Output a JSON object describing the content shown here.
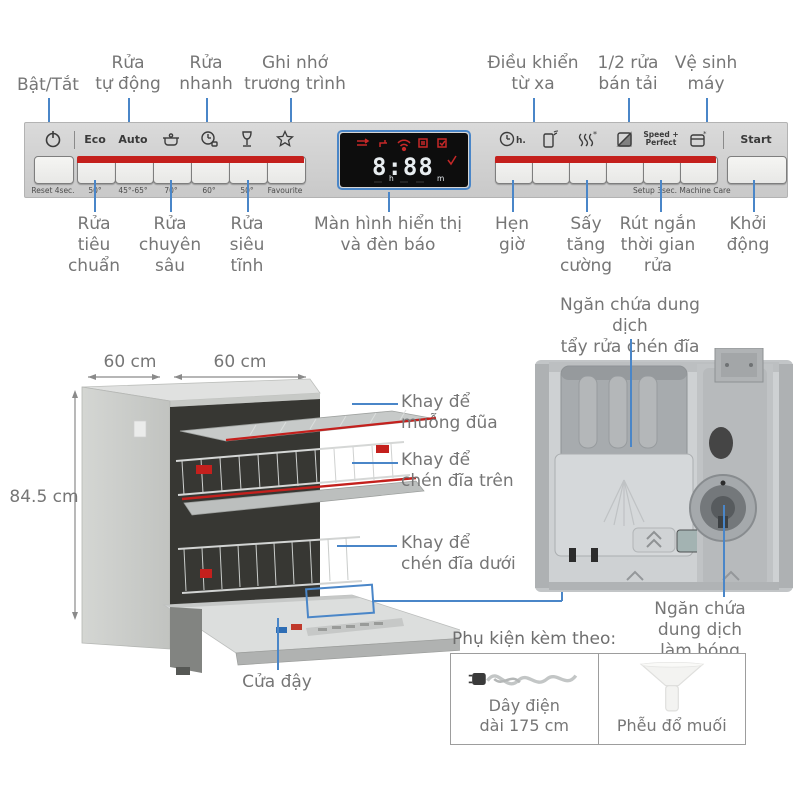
{
  "top_labels": [
    {
      "text": "Bật/Tắt"
    },
    {
      "text": "Rửa\ntự động"
    },
    {
      "text": "Rửa\nnhanh"
    },
    {
      "text": "Ghi nhớ\ntrương trình"
    },
    {
      "text": "Điều khiển\ntừ xa"
    },
    {
      "text": "1/2 rửa\nbán tải"
    },
    {
      "text": "Vệ sinh\nmáy"
    }
  ],
  "bottom_labels": [
    {
      "text": "Rửa\ntiêu\nchuẩn"
    },
    {
      "text": "Rửa\nchuyên\nsâu"
    },
    {
      "text": "Rửa\nsiêu\ntĩnh"
    },
    {
      "text": "Màn hình hiển thị\nvà đèn báo"
    },
    {
      "text": "Hẹn\ngiờ"
    },
    {
      "text": "Sấy\ntăng\ncường"
    },
    {
      "text": "Rút ngắn\nthời gian\nrửa"
    },
    {
      "text": "Khởi\nđộng"
    }
  ],
  "panel": {
    "left": {
      "eco": "Eco",
      "auto": "Auto",
      "captions": [
        "Reset 4sec.",
        "50°",
        "45°-65°",
        "70°",
        "60°",
        "50°",
        "Favourite"
      ]
    },
    "display": {
      "time": "8:88",
      "hour_unit": "h",
      "minute_unit": "m"
    },
    "right": {
      "hour": "h.",
      "speed_label": "Speed +\nPerfect",
      "start": "Start",
      "captions": [
        "Setup 3sec.",
        "Machine Care"
      ]
    }
  },
  "dishwasher": {
    "dim_depth": "60 cm",
    "dim_width": "60 cm",
    "dim_height": "84.5 cm",
    "labels": {
      "cutlery_tray": "Khay để\nmuỗng đũa",
      "upper_rack": "Khay để\nchén đĩa trên",
      "lower_rack": "Khay để\nchén đĩa dưới",
      "door": "Cửa đậy"
    }
  },
  "dispenser": {
    "detergent_label": "Ngăn chứa dung dịch\ntẩy rửa chén đĩa",
    "rinse_aid_label": "Ngăn chứa dung dịch\nlàm bóng chén đĩa"
  },
  "accessories": {
    "title": "Phụ kiện kèm theo:",
    "items": [
      {
        "caption": "Dây điện\ndài 175 cm"
      },
      {
        "caption": "Phễu đổ muối"
      }
    ]
  },
  "colors": {
    "callout_blue": "#4a86c8",
    "program_red": "#c4201d",
    "label_gray": "#767676"
  }
}
